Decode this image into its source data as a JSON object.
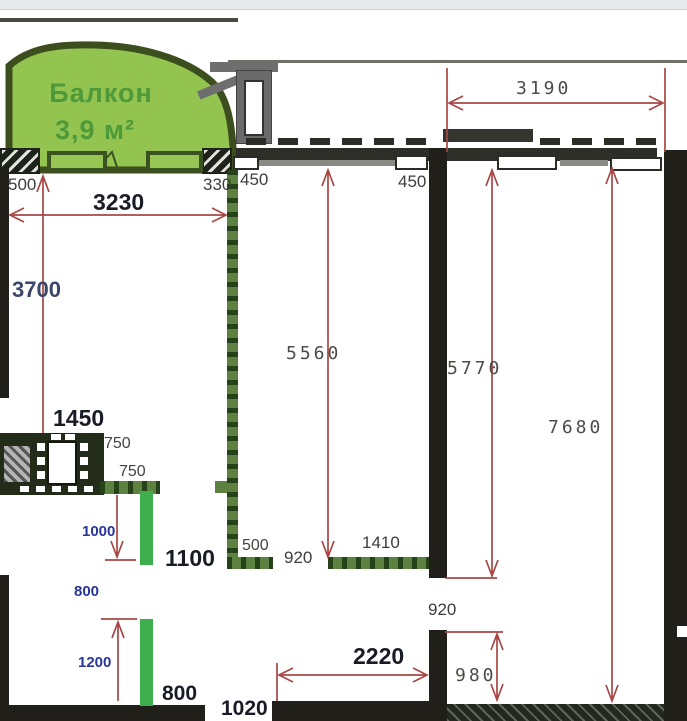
{
  "plan": {
    "balcony": {
      "name": "Балкон",
      "area": "3,9 м²"
    },
    "labels": {
      "d3190": "3190",
      "d500_top": "500",
      "d330": "330",
      "d3230": "3230",
      "d3700": "3700",
      "d450_left": "450",
      "d450_right": "450",
      "d5560": "5560",
      "d5770": "5770",
      "d7680": "7680",
      "d1450": "1450",
      "d750_upper": "750",
      "d750_lower": "750",
      "d1000": "1000",
      "d1100": "1100",
      "d800_mid": "800",
      "d1200": "1200",
      "d800_bottom": "800",
      "d500_bottom": "500",
      "d920_mid": "920",
      "d1410": "1410",
      "d920_right": "920",
      "d2220": "2220",
      "d980": "980",
      "d1020": "1020"
    },
    "colors": {
      "dimension_red": "#a84745",
      "balcony_fill": "#92c44f",
      "balcony_border": "#3c4e1e",
      "balcony_text": "#4e9a3b",
      "partition_green": "#5c8140",
      "new_wall_green": "#3fae4c",
      "wall_black": "#201f19",
      "blue_label": "#28359b"
    }
  }
}
